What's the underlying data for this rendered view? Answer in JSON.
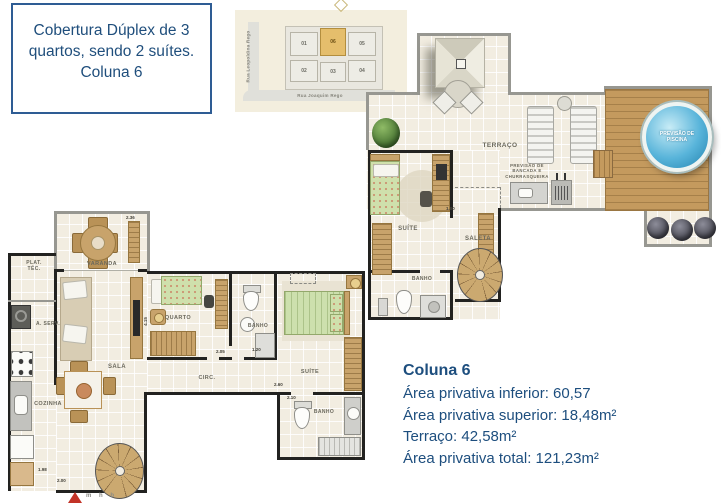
{
  "info_box": {
    "text": "Cobertura Dúplex de 3\nquartos, sendo 2 suítes.\nColuna 6"
  },
  "site_map": {
    "street_left": "Rua Leopoldina Rego",
    "street_bottom": "Rua Joaquim Rego",
    "units": [
      {
        "label": "01",
        "highlighted": false
      },
      {
        "label": "02",
        "highlighted": false
      },
      {
        "label": "03",
        "highlighted": false
      },
      {
        "label": "04",
        "highlighted": false
      },
      {
        "label": "05",
        "highlighted": false
      },
      {
        "label": "06",
        "highlighted": true
      }
    ]
  },
  "upper_plan": {
    "labels": {
      "terraco": "TERRAÇO",
      "piscina": "PREVISÃO DE PISCINA",
      "bancada": "PREVISÃO DE\nBANCADA E\nCHURRASQUEIRA",
      "suite": "SUÍTE",
      "saleta": "SALETA",
      "banho": "BANHO"
    },
    "dims": {
      "d1": "1.80"
    }
  },
  "lower_plan": {
    "labels": {
      "varanda": "VARANDA",
      "plat_tec": "PLAT.\nTÉC.",
      "a_serv": "A. SERV.",
      "cozinha": "COZINHA",
      "sala": "SALA",
      "quarto": "QUARTO",
      "banho1": "BANHO",
      "circ": "CIRC.",
      "suite": "SUÍTE",
      "banho2": "BANHO"
    },
    "dims": {
      "d1": "2.36",
      "d2": "1.98",
      "d3": "2.00",
      "d4": "4.15",
      "d5": "2.05",
      "d6": "1.20",
      "d7": "2.60",
      "d8": "2.10"
    }
  },
  "areas": {
    "title": "Coluna 6",
    "lines": [
      "Área privativa inferior: 60,57",
      "Área privativa superior: 18,48m²",
      "Terraço: 42,58m²",
      "Área privativa total: 121,23m²"
    ]
  },
  "footer": {
    "logo_text": "m h b"
  },
  "colors": {
    "accent_blue": "#1f4e7c",
    "box_border_blue": "#2e5c94",
    "plan_cream": "#f2ede1",
    "wall_dark": "#222220",
    "wall_gray": "#979791",
    "wood_tan": "#c8a36b",
    "deck_wood": "#c49a5e",
    "bed_green": "#cfe0ac",
    "pool_blue": "#58b4da",
    "unit_highlight": "#e5be6c",
    "logo_red": "#c23327"
  }
}
